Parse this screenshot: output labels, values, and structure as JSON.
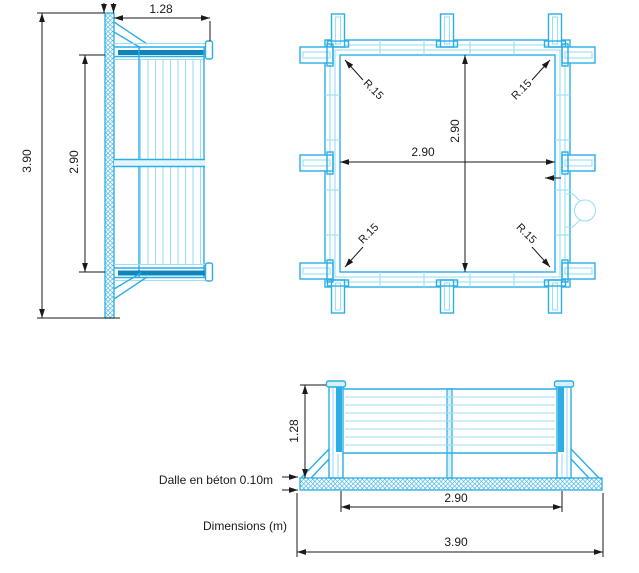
{
  "colors": {
    "line_strong": "#2AAEE5",
    "line_light": "#9BDEF6",
    "fill_dark": "#0E86BC",
    "fill_pale": "#D6F1FC",
    "dimension_lines": "#1A1A1A",
    "background": "#FFFFFF"
  },
  "side_view": {
    "dim_total_height": "3.90",
    "dim_inner_height": "2.90",
    "dim_top_width": "1.28"
  },
  "plan_view": {
    "dim_width": "2.90",
    "dim_depth": "2.90",
    "radius_top_left": "R.15",
    "radius_top_right": "R.15",
    "radius_bottom_left": "R.15",
    "radius_bottom_right": "R.15"
  },
  "front_view": {
    "dim_height": "1.28",
    "dim_inner_width": "2.90",
    "dim_total_width": "3.90"
  },
  "annotations": {
    "slab_label": "Dalle en béton 0.10m",
    "units_label": "Dimensions (m)"
  }
}
